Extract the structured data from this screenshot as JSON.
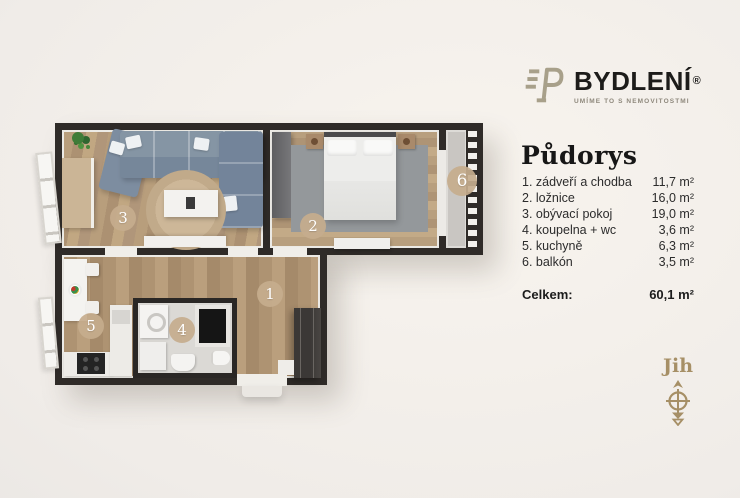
{
  "brand": {
    "name": "BYDLENÍ",
    "reg": "®",
    "tagline": "UMÍME TO S NEMOVITOSTMI"
  },
  "panel": {
    "title": "Půdorys",
    "rooms": [
      {
        "label": "1. zádveří a chodba",
        "area": "11,7 m²"
      },
      {
        "label": "2. ložnice",
        "area": "16,0 m²"
      },
      {
        "label": "3. obývací pokoj",
        "area": "19,0 m²"
      },
      {
        "label": "4. koupelna + wc",
        "area": "3,6 m²"
      },
      {
        "label": "5. kuchyně",
        "area": "6,3 m²"
      },
      {
        "label": "6. balkón",
        "area": "3,5 m²"
      }
    ],
    "total_label": "Celkem:",
    "total_area": "60,1 m²"
  },
  "compass": {
    "label": "Jih"
  },
  "plan": {
    "badges": {
      "hall": "1",
      "bedroom": "2",
      "living": "3",
      "bath": "4",
      "kitchen": "5",
      "balcony": "6"
    }
  },
  "colors": {
    "accent_gold": "#a68f66",
    "badge_tan": "#c5ad8d",
    "wall_dark": "#2f2b28",
    "logo_olive": "#a8a08a",
    "background": "#f0ece8"
  }
}
